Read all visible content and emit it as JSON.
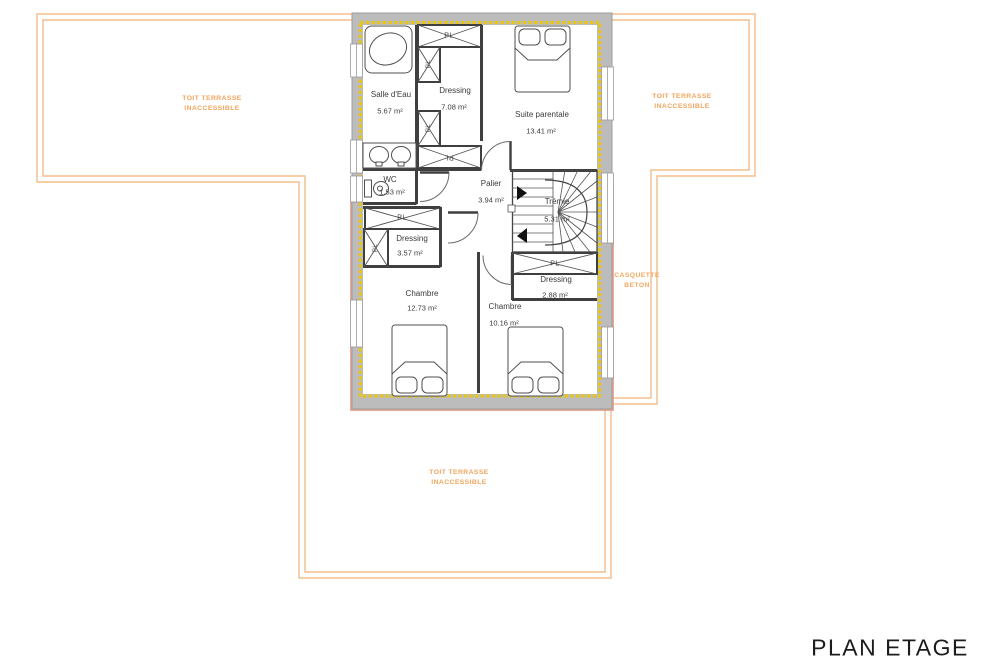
{
  "title": "PLAN ETAGE",
  "annotations": {
    "terrace_left": "TOIT TERRASSE\nINACCESSIBLE",
    "terrace_right": "TOIT TERRASSE\nINACCESSIBLE",
    "terrace_bottom": "TOIT TERRASSE\nINACCESSIBLE",
    "casquette": "CASQUETTE\nBETON"
  },
  "rooms": {
    "salle_deau": {
      "name": "Salle d'Eau",
      "area": "5.67 m²"
    },
    "dressing_nord": {
      "name": "Dressing",
      "area": "7.08 m²"
    },
    "suite_parentale": {
      "name": "Suite parentale",
      "area": "13.41 m²"
    },
    "wc": {
      "name": "WC",
      "area": "1.53 m²"
    },
    "palier": {
      "name": "Palier",
      "area": "3.94 m²"
    },
    "tremie": {
      "name": "Trémie",
      "area": "5.31 m²"
    },
    "dressing_ouest": {
      "name": "Dressing",
      "area": "3.57 m²"
    },
    "chambre_ouest": {
      "name": "Chambre",
      "area": "12.73 m²"
    },
    "chambre_sud": {
      "name": "Chambre",
      "area": "10.16 m²"
    },
    "dressing_est": {
      "name": "Dressing",
      "area": "2.88 m²"
    }
  },
  "closets": {
    "pl": "PL"
  },
  "colors": {
    "terrace_outline": "#f3bd8b",
    "terrace_text": "#f2a55c",
    "casquette_text": "#f5a95f",
    "wall_fill": "#bcbcbc",
    "wall_edge": "#9b9b9b",
    "insulation": "#e9c512",
    "interior_wall": "#3f3f3f",
    "casquette_salmon": "#e9a18f",
    "label_text": "#3a3a3a",
    "title_text": "#1c1c1c"
  }
}
